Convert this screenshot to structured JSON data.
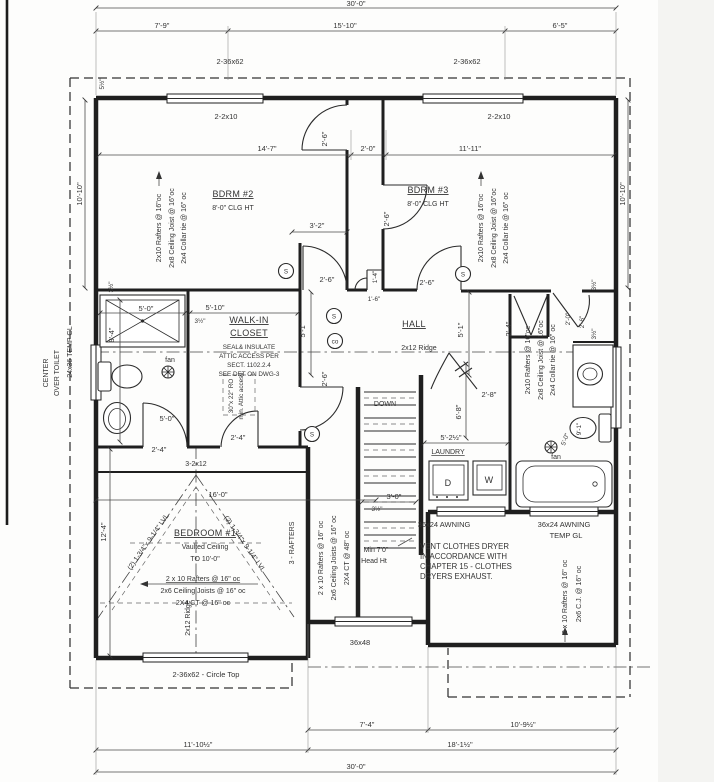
{
  "colors": {
    "wall": "#1f1f1f",
    "dim_line": "#4a4a4a",
    "text": "#333333",
    "paper": "#fdfdfc"
  },
  "rooms": {
    "bdrm2": {
      "name": "BDRM #2",
      "clg": "8'-0\" CLG HT"
    },
    "bdrm3": {
      "name": "BDRM #3",
      "clg": "8'-0\" CLG HT"
    },
    "bedroom1": {
      "name": "BEDROOM #1",
      "sub1": "Vaulted Ceiling",
      "sub2": "TO 10'-0\""
    },
    "wic": {
      "line1": "WALK-IN",
      "line2": "CLOSET"
    },
    "hall": "HALL",
    "laundry": "LAUNDRY",
    "stairs_down": "DOWN"
  },
  "fixtures": {
    "dryer": "D",
    "washer": "W",
    "fan_left": "fan",
    "fan_right": "fan",
    "smoke": "S",
    "carbon_monoxide": "co"
  },
  "windows": {
    "top_left": "2-36x62",
    "top_right": "2-36x62",
    "left_size": "24x36  TEMP GL",
    "left_note1": "CENTER",
    "left_note2": "OVER TOILET",
    "bottom_circle_top": "2-36x62 - Circle Top",
    "mid_bottom": "36x48",
    "awning_left": "36x24 AWNING",
    "awning_right1": "36x24 AWNING",
    "awning_right2": "TEMP GL"
  },
  "framing": {
    "hdr_left": "2-2x10",
    "hdr_right": "2-2x10",
    "bdrm2_rafters": "2x10 Rafters @ 16\"oc",
    "bdrm2_joist": "2x8 Ceiling Joist @ 16\"oc",
    "bdrm2_collar": "2x4 Collar tie @ 16\" oc",
    "bdrm3_rafters": "2x10 Rafters @ 16\"oc",
    "bdrm3_joist": "2x8 Ceiling Joist @ 16\"oc",
    "bdrm3_collar": "2x4 Collar tie @ 16\" oc",
    "bath_rafters": "2x10 Rafters @ 16\"oc",
    "bath_joist": "2x8 Ceiling Joist @ 16\"oc",
    "bath_collar": "2x4 Collar tie @ 16\" oc",
    "ridge_hall": "2x12 Ridge",
    "ridge_bdrm1": "2x12 Ridge",
    "beam": "3-2x12",
    "lvl_left": "(2) 1-3/4\"x 9-1/4\" LVL",
    "lvl_right": "(2) 1-3/4\"x 9-1/4\" LVL",
    "bdrm1_rafters": "2 x 10 Rafters @ 16\" oc",
    "bdrm1_joists": "2x6 Ceiling Joists @ 16\" oc",
    "bdrm1_ct": "2X4 CT @ 16\" oc",
    "rafters3": "3 - RAFTERS",
    "mid_rafters": "2 x 10 Rafters @ 16\" oc",
    "mid_joists": "2x6 Ceiling Joists @ 16\" oc",
    "mid_ct": "2X4 CT @ 48\" oc",
    "br_rafters": "2 x 10 Rafters @ 16\" oc",
    "br_cj": "2x6 C.J. @ 16\" oc"
  },
  "notes": {
    "attic1": "SEAL& INSULATE",
    "attic2": "ATTIC ACCESS PER",
    "attic3": "SECT. 1102.2.4",
    "attic4": "SEE DET ON DWG-3",
    "attic_ro1": "30\"x 22\" RO",
    "attic_ro2": "min. Attic access",
    "vent1": "VENT CLOTHES DRYER",
    "vent2": "IN ACCORDANCE WITH",
    "vent3": "CHAPTER 15 - CLOTHES",
    "vent4": "DRYERS EXHAUST.",
    "head1": "Min 7'0\"",
    "head2": "Head Ht"
  },
  "dims": {
    "overall_top": "30'-0\"",
    "t1": "7'-9\"",
    "t2": "15'-10\"",
    "t3": "6'-5\"",
    "i1": "14'-7\"",
    "i2": "2'-0\"",
    "i3": "11'-11\"",
    "left_v": "10'-10\"",
    "right_v": "10'-10\"",
    "wall_thk": "5½\"",
    "door_a": "2'-6\"",
    "door_b": "2'-6\"",
    "door_c": "2'-6\"",
    "door_d": "2'-6\"",
    "door_g": "2'-6\"",
    "nook": "3'-2\"",
    "niche": "1'-4\"",
    "niche_door": "1'-6\"",
    "hall_l": "5'-1\"",
    "hall_r": "5'-1\"",
    "shower_w": "5'-0\"",
    "wic_w": "5'-10\"",
    "bath_l": "8'-4\"",
    "thk_a": "3½\"",
    "thk_b": "3½\"",
    "thk_c": "3½\"",
    "thk_d": "3½\"",
    "thk_e": "3½\"",
    "bath_door": "5'-0\"",
    "bath_door2": "2'-4\"",
    "wic_door": "2'-4\"",
    "bed1_w": "16'-0\"",
    "bed1_d": "12'-4\"",
    "stair_w": "3'-0\"",
    "stair_len": "6'-8\"",
    "laundry_w": "5'-2½\"",
    "laundry_door": "2'-8\"",
    "closet_r": "2'-4\"",
    "door_r1": "2'-0\"",
    "door_r2": "2'-6\"",
    "bath_r_w": "5'-0\"",
    "bath_r_l": "9'-1\"",
    "b1": "7'-4\"",
    "b2": "10'-9½\"",
    "b3": "11'-10½\"",
    "b4": "18'-1½\"",
    "overall_bottom": "30'-0\""
  }
}
